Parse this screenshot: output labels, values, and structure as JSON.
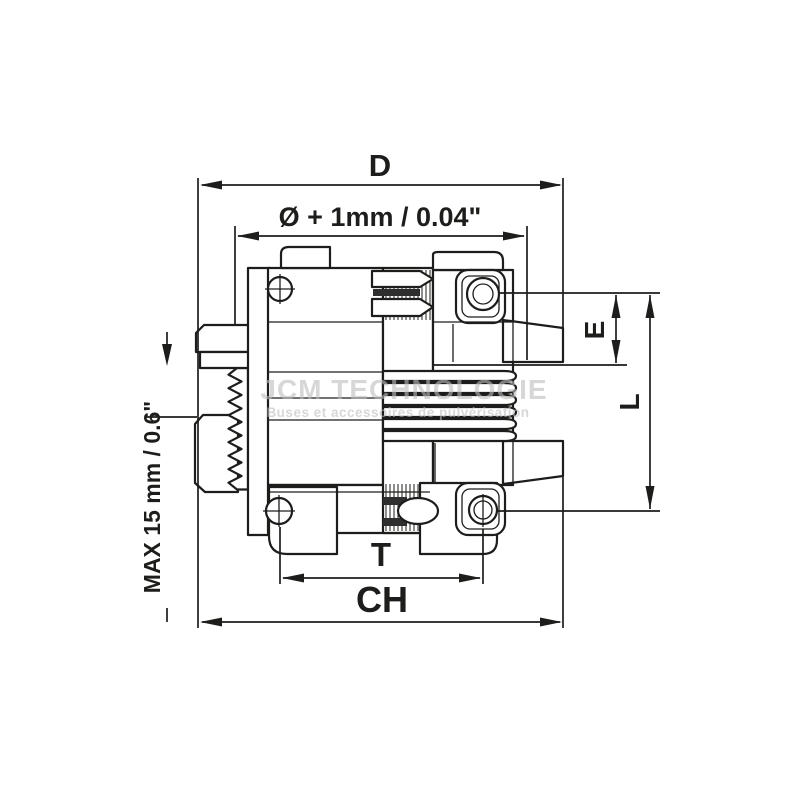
{
  "dimensions": {
    "d_label": "D",
    "diameter_label": "Ø + 1mm / 0.04\"",
    "e_label": "E",
    "l_label": "L",
    "t_label": "T",
    "ch_label": "CH",
    "max_label": "MAX 15 mm / 0.6\""
  },
  "watermark": {
    "title": "JCM TECHNOLOGIE",
    "subtitle": "Buses et accessoires de pulvérisation"
  },
  "colors": {
    "line": "#1d1d1b",
    "flange_gray": "#b9b9b9",
    "washer_gray": "#9a9a9a",
    "nut_gray": "#878787",
    "slot_dark": "#2e2e2e",
    "watermark_gray": "#bdbdbd"
  }
}
